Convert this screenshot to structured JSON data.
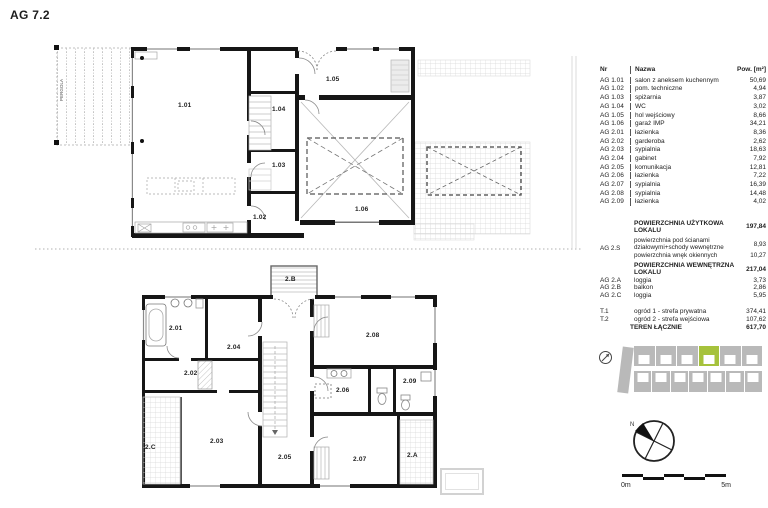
{
  "title": "AG 7.2",
  "pergola_label": "PERGOLA",
  "plans": {
    "ground": {
      "rooms": [
        {
          "label": "1.01"
        },
        {
          "label": "1.02"
        },
        {
          "label": "1.03"
        },
        {
          "label": "1.04"
        },
        {
          "label": "1.05"
        },
        {
          "label": "1.06"
        }
      ]
    },
    "upper": {
      "rooms": [
        {
          "label": "2.01"
        },
        {
          "label": "2.02"
        },
        {
          "label": "2.03"
        },
        {
          "label": "2.04"
        },
        {
          "label": "2.05"
        },
        {
          "label": "2.06"
        },
        {
          "label": "2.07"
        },
        {
          "label": "2.08"
        },
        {
          "label": "2.09"
        },
        {
          "label": "2.A"
        },
        {
          "label": "2.B"
        },
        {
          "label": "2.C"
        }
      ]
    }
  },
  "table": {
    "headers": {
      "nr": "Nr",
      "name": "Nazwa",
      "area": "Pow. [m²]"
    },
    "rows": [
      {
        "nr": "AG 1.01",
        "name": "salon z aneksem kuchennym",
        "area": "50,69"
      },
      {
        "nr": "AG 1.02",
        "name": "pom. techniczne",
        "area": "4,94"
      },
      {
        "nr": "AG 1.03",
        "name": "spiżarnia",
        "area": "3,87"
      },
      {
        "nr": "AG 1.04",
        "name": "WC",
        "area": "3,02"
      },
      {
        "nr": "AG 1.05",
        "name": "hol wejściowy",
        "area": "8,66"
      },
      {
        "nr": "AG 1.06",
        "name": "garaż IMP",
        "area": "34,21"
      },
      {
        "nr": "AG 2.01",
        "name": "łazienka",
        "area": "8,36"
      },
      {
        "nr": "AG 2.02",
        "name": "garderoba",
        "area": "2,62"
      },
      {
        "nr": "AG 2.03",
        "name": "sypialnia",
        "area": "18,63"
      },
      {
        "nr": "AG 2.04",
        "name": "gabinet",
        "area": "7,92"
      },
      {
        "nr": "AG 2.05",
        "name": "komunikacja",
        "area": "12,81"
      },
      {
        "nr": "AG 2.06",
        "name": "łazienka",
        "area": "7,22"
      },
      {
        "nr": "AG 2.07",
        "name": "sypialnia",
        "area": "16,39"
      },
      {
        "nr": "AG 2.08",
        "name": "sypialnia",
        "area": "14,48"
      },
      {
        "nr": "AG 2.09",
        "name": "łazienka",
        "area": "4,02"
      }
    ],
    "summary": {
      "usable": {
        "label": "POWIERZCHNIA UŻYTKOWA LOKALU",
        "value": "197,84"
      },
      "s_nr": "AG 2.S",
      "s_row1": {
        "label": "powierzchnia pod ścianami działowymi+schody wewnętrzne",
        "value": "8,93"
      },
      "s_row2": {
        "label": "powierzchnia wnęk okiennych",
        "value": "10,27"
      },
      "internal": {
        "label": "POWIERZCHNIA WEWNĘTRZNA LOKALU",
        "value": "217,04"
      },
      "extras": [
        {
          "nr": "AG 2.A",
          "name": "loggia",
          "area": "3,73"
        },
        {
          "nr": "AG 2.B",
          "name": "balkon",
          "area": "2,86"
        },
        {
          "nr": "AG 2.C",
          "name": "loggia",
          "area": "5,95"
        }
      ],
      "terrain": [
        {
          "nr": "T.1",
          "name": "ogród 1 - strefa prywatna",
          "area": "374,41"
        },
        {
          "nr": "T.2",
          "name": "ogród 2 - strefa wejściowa",
          "area": "107,62"
        }
      ],
      "total": {
        "label": "TEREN ŁĄCZNIE",
        "value": "617,70"
      }
    }
  },
  "compass": {
    "north": "N"
  },
  "scalebar": {
    "start": "0m",
    "end": "5m"
  },
  "colors": {
    "highlight_green": "#a6c23c",
    "site_gray": "#b9b9b9",
    "wall_black": "#161616"
  }
}
